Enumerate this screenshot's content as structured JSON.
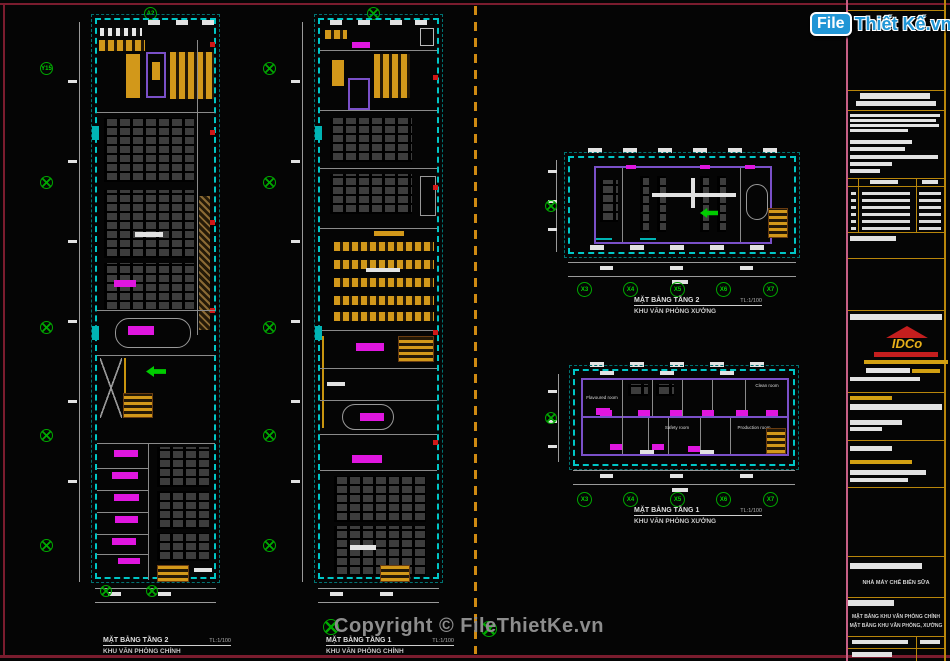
{
  "watermark": {
    "text": "Copyright © FileThietKe.vn"
  },
  "site_logo": {
    "prefix": "File",
    "suffix": "Thiết Kế.vn"
  },
  "plans": [
    {
      "title": "MẶT BẰNG TẦNG 2",
      "scale": "TL:1/100",
      "subtitle": "KHU VĂN PHÒNG CHÍNH"
    },
    {
      "title": "MẶT BẰNG TẦNG 1",
      "scale": "TL:1/100",
      "subtitle": "KHU VĂN PHÒNG CHÍNH"
    },
    {
      "title": "MẶT BẰNG TẦNG 2",
      "scale": "TL:1/100",
      "subtitle": "KHU VĂN PHÒNG XƯỞNG"
    },
    {
      "title": "MẶT BẰNG TẦNG 1",
      "scale": "TL:1/100",
      "subtitle": "KHU VĂN PHÒNG XƯỞNG",
      "rooms": {
        "flavoured": "Flavoured room",
        "safety": "Safety room",
        "production": "Production room",
        "clean": "Clean room"
      }
    }
  ],
  "axes": {
    "x_labels": [
      "X3",
      "X4",
      "X5",
      "X6",
      "X7"
    ],
    "top_label": "A2",
    "left_label": "Y15"
  },
  "title_block": {
    "company": "IDCo",
    "project": "NHÀ MÁY CHẾ BIẾN SỮA",
    "drawing_1": "MẶT BẰNG KHU VĂN PHÒNG CHÍNH",
    "drawing_2": "MẶT BẰNG KHU VĂN PHÒNG, XƯỞNG"
  },
  "colors": {
    "plan_boundary": "#00c6c6",
    "highlight_magenta": "#e016e0",
    "furniture_orange": "#d2981a",
    "axis_marker_green": "#00a800",
    "wall_accent_purple": "#7a50c8",
    "divider_orange": "#cf8a12",
    "frame_maroon": "#7a1c2e",
    "title_block_edge_pink": "#c75f85",
    "logo_blue": "#2196d6",
    "watermark_gray": "#8d8d8d"
  }
}
